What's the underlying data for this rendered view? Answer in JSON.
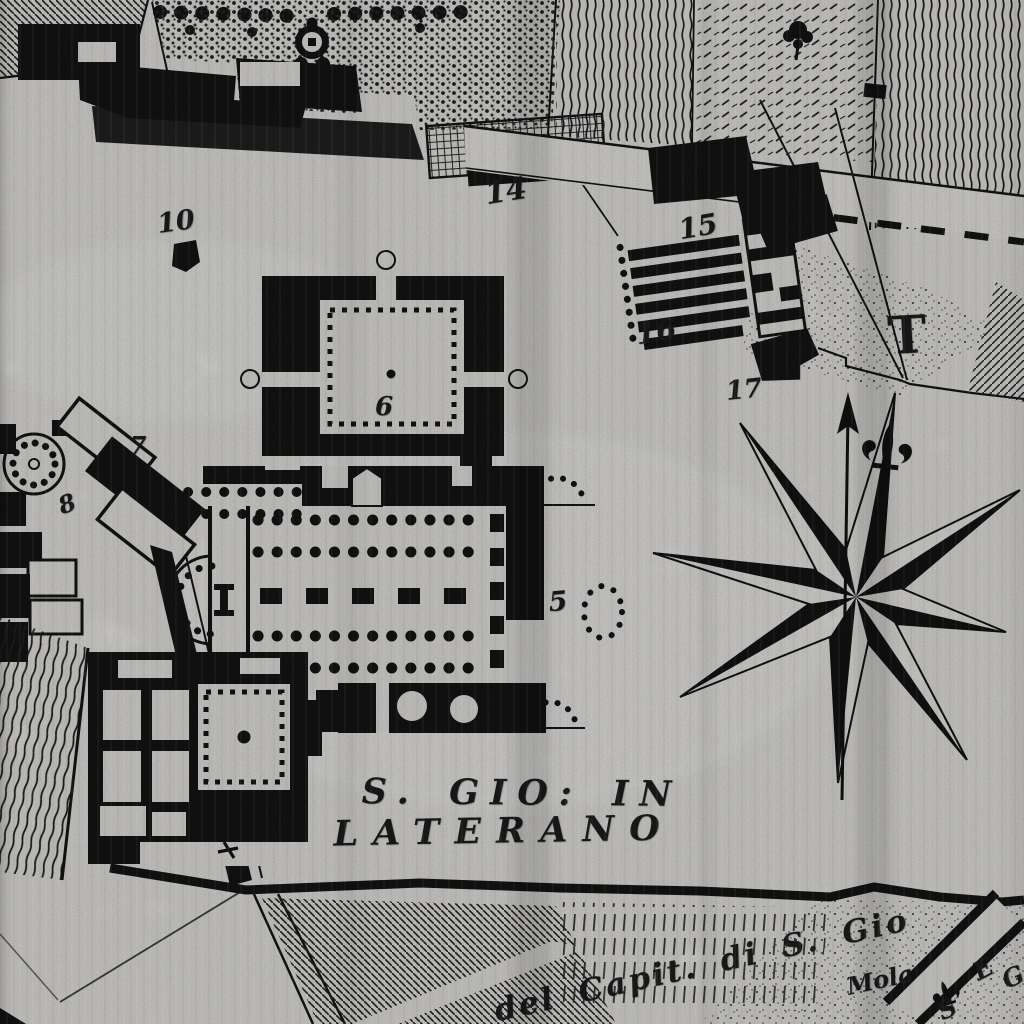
{
  "palette": {
    "paper": "#efeeea",
    "ink": "#161616"
  },
  "title": {
    "line1": "S. GIO: IN",
    "line2": "LATERANO"
  },
  "numbers": {
    "n5": "5",
    "n6": "6",
    "n7": "7",
    "n8": "8",
    "n10": "10",
    "n14": "14",
    "n15": "15",
    "n16": "16",
    "n17": "17"
  },
  "letters": {
    "t": "T"
  },
  "captions": {
    "road": "del Capit. di S. Gio",
    "mill": "Mola",
    "corner_a": "E",
    "corner_b": "S",
    "corner_c": "G"
  },
  "icons": {
    "compass": "eight-point-compass-rose-with-north-arrow-and-fleur-de-lis"
  }
}
